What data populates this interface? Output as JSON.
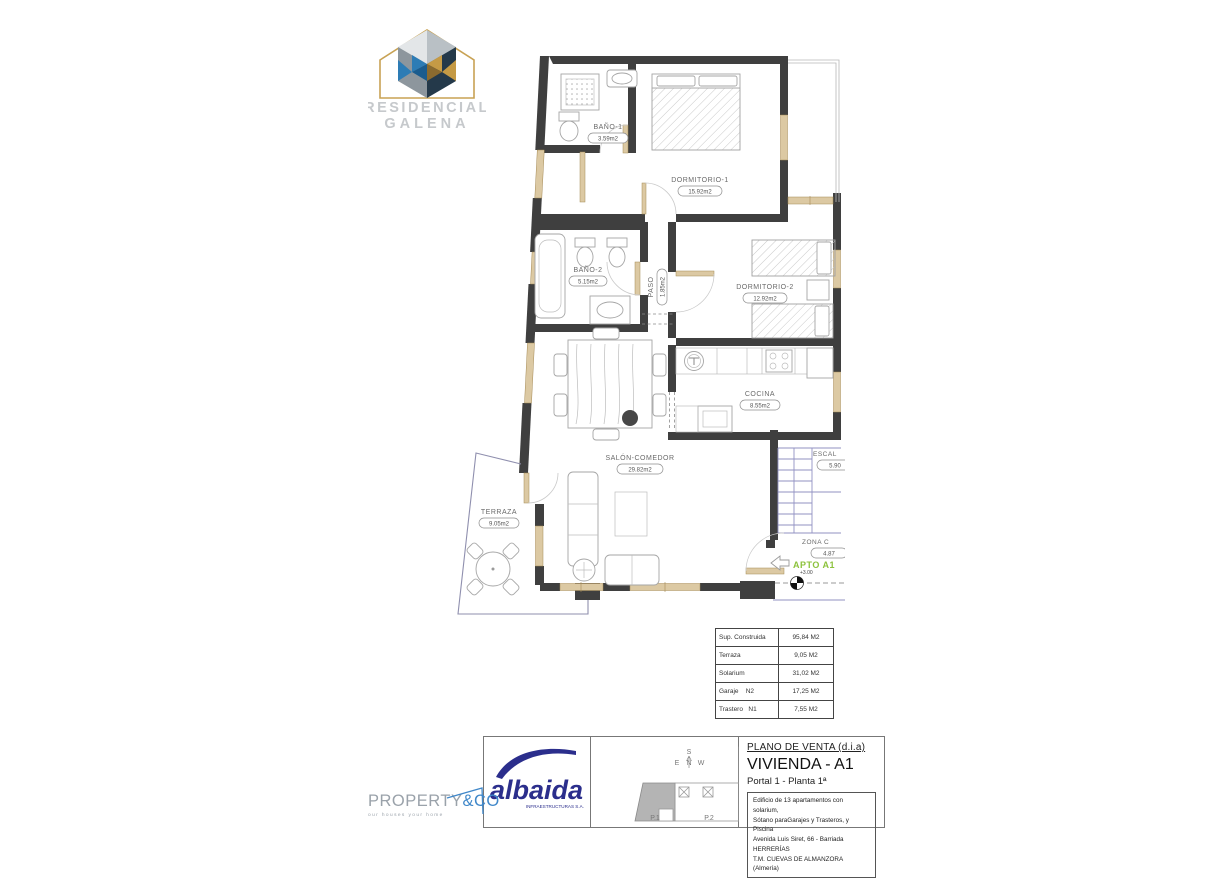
{
  "brand": {
    "residencial": {
      "line1": "RESIDENCIAL",
      "line2": "GALENA"
    },
    "albaida": {
      "name": "albaida",
      "subtitle": "INFRAESTRUCTURAS S.A."
    },
    "property_co": {
      "part1": "PROPERTY",
      "part2": "&CO",
      "tagline": "our houses your home"
    }
  },
  "plan": {
    "rooms": {
      "bano1": {
        "name": "BAÑO-1",
        "area": "3.59m2"
      },
      "dormitorio1": {
        "name": "DORMITORIO-1",
        "area": "15.92m2"
      },
      "bano2": {
        "name": "BAÑO-2",
        "area": "5.15m2"
      },
      "paso": {
        "name": "PASO",
        "area": "1.85m2"
      },
      "dormitorio2": {
        "name": "DORMITORIO-2",
        "area": "12.92m2"
      },
      "cocina": {
        "name": "COCINA",
        "area": "8.55m2"
      },
      "salon": {
        "name": "SALÓN-COMEDOR",
        "area": "29.82m2"
      },
      "terraza": {
        "name": "TERRAZA",
        "area": "9.05m2"
      },
      "escalera": {
        "name": "ESCAL",
        "area": "5.90"
      },
      "zona_comun": {
        "name": "ZONA  C",
        "area": "4.87"
      }
    },
    "apartment_label": "APTO A1",
    "level_mark": "+3.00"
  },
  "areas_table": {
    "rows": [
      {
        "label": "Sup. Construida",
        "value": "95,84 M2"
      },
      {
        "label": "Terraza",
        "value": "9,05 M2"
      },
      {
        "label": "Solarium",
        "value": "31,02 M2"
      },
      {
        "label": "Garaje    N2",
        "value": "17,25 M2"
      },
      {
        "label": "Trastero   N1",
        "value": "7,55 M2"
      }
    ]
  },
  "title_block": {
    "doc_type": "PLANO DE VENTA (d.i.a)",
    "title": "VIVIENDA - A1",
    "subtitle": "Portal 1 - Planta 1ª",
    "description_lines": [
      "Edificio de 13 apartamentos con solarium,",
      "Sótano paraGarajes y Trasteros, y Piscina",
      "Avenida Luis Siret, 66 - Barriada HERRERÍAS",
      "T.M. CUEVAS DE ALMANZORA (Almería)"
    ],
    "site_plan": {
      "compass": {
        "n": "N",
        "s": "S",
        "e": "E",
        "w": "W"
      },
      "portals": [
        "P.1",
        "P.2",
        "P.3"
      ]
    }
  },
  "colors": {
    "wall": "#3f3f3f",
    "window": "#dcc9a3",
    "stairs_line": "#9191c2",
    "accent_green": "#8cc23c",
    "albaida_blue": "#2b2e8c",
    "property_blue": "#3f87c9"
  }
}
